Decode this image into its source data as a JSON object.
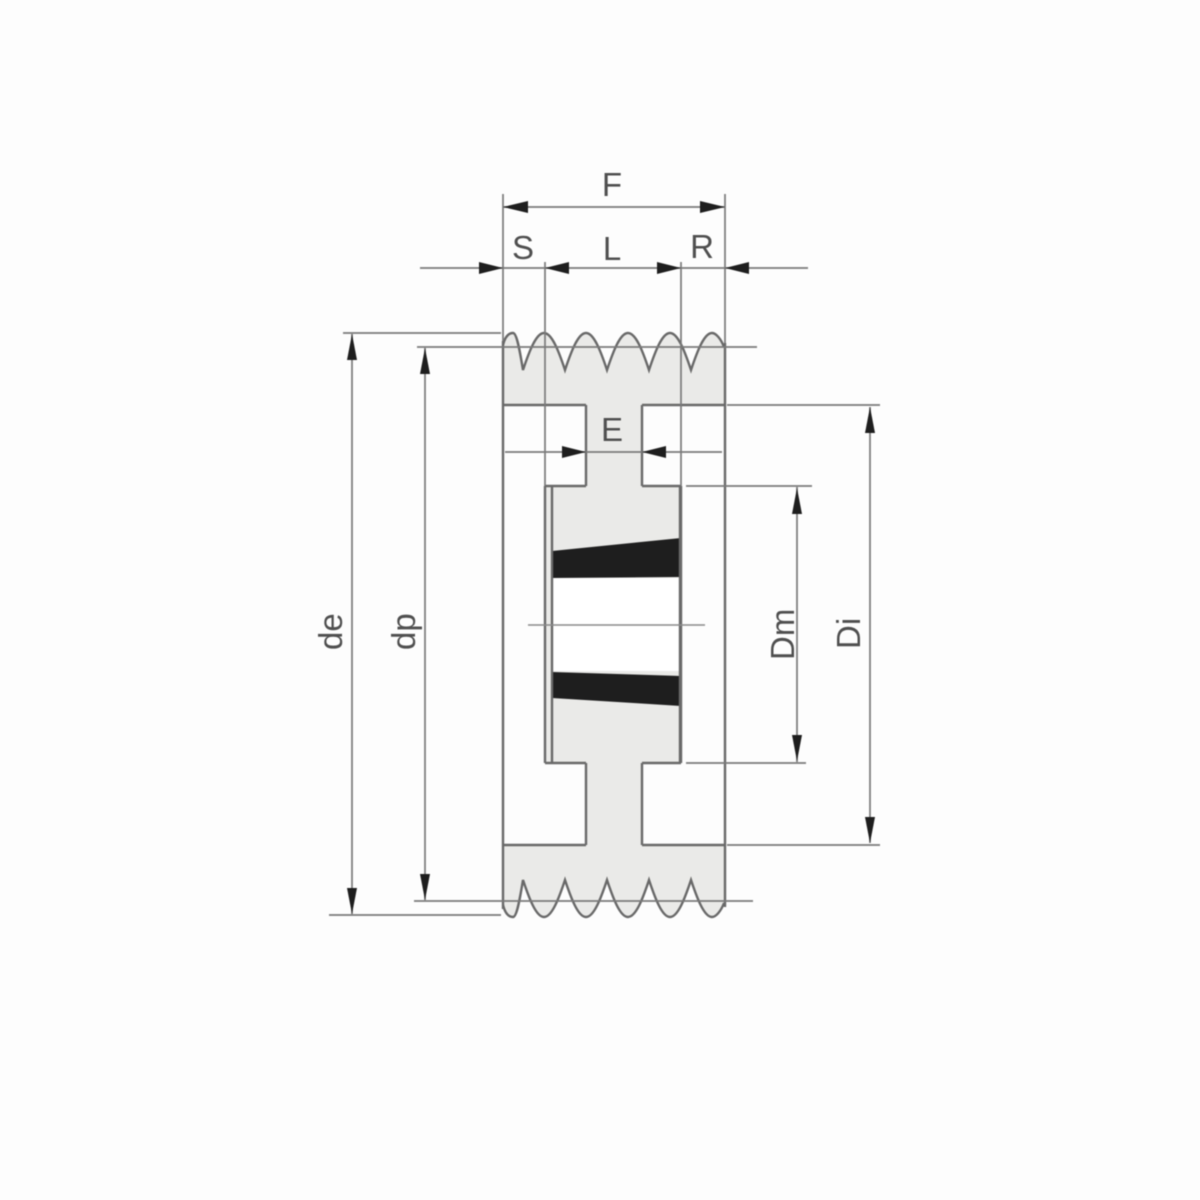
{
  "figure": {
    "title": "Taper-bushing V-belt pulley cross-section drawing",
    "dimension_labels": {
      "overall_width": "F",
      "offset_left": "S",
      "bushing_length": "L",
      "offset_right": "R",
      "web_thickness": "E",
      "outside_diameter": "de",
      "pitch_diameter": "dp",
      "hub_diameter": "Dm",
      "inner_diameter": "Di"
    },
    "colors": {
      "background": "#fdfdfd",
      "metal_fill": "#eaeae8",
      "outline": "#696969",
      "dimension_line": "#7a7a7a",
      "arrowhead": "#1e1e1e",
      "label_text": "#4f4f4f"
    }
  }
}
